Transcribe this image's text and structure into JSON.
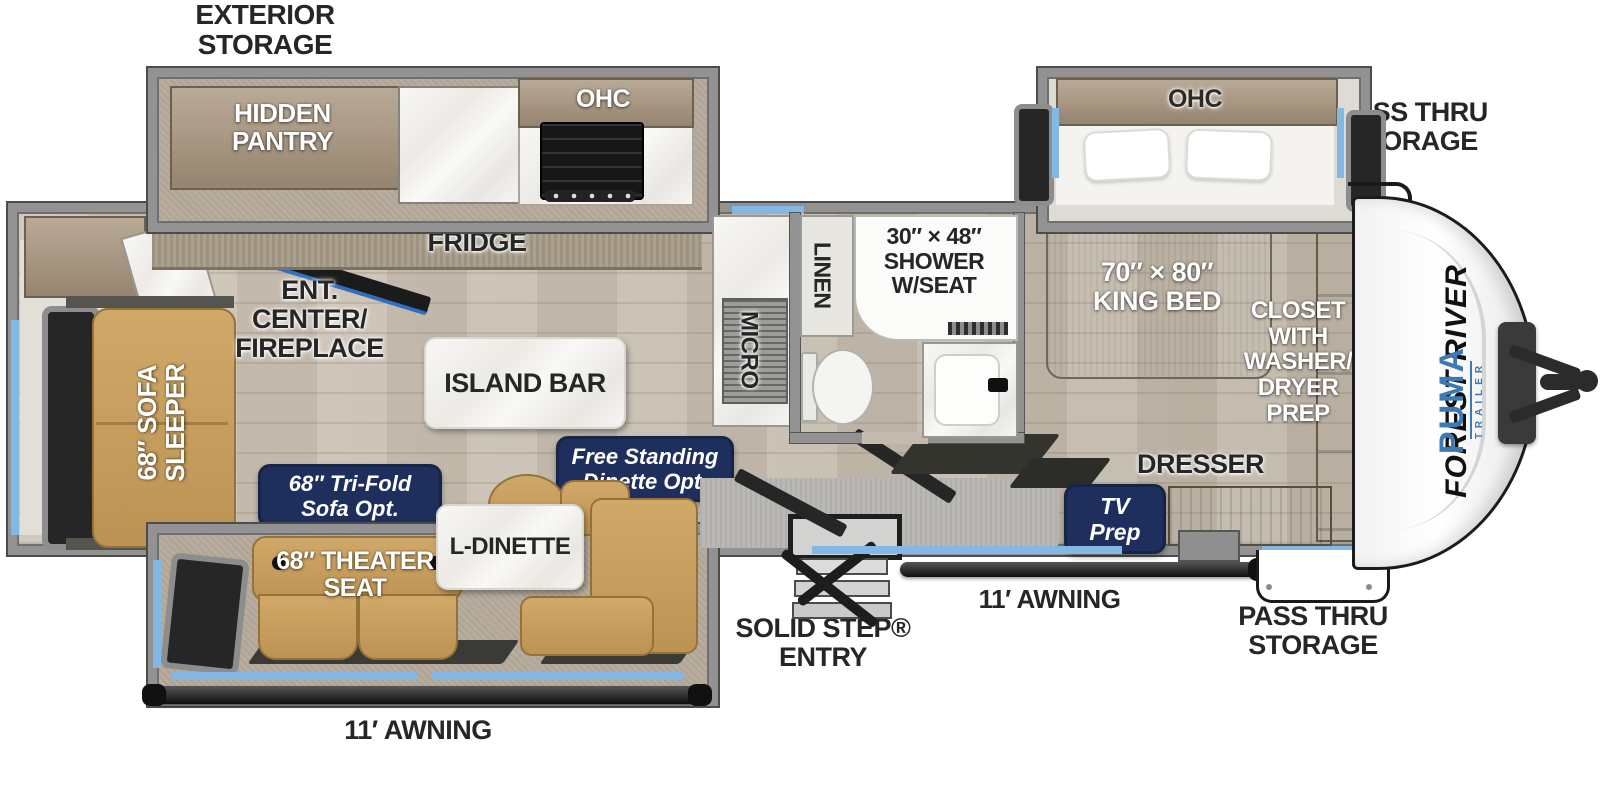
{
  "title": "Forest River Puma travel trailer floor plan",
  "labels": {
    "exterior_storage": "EXTERIOR\nSTORAGE",
    "pass_thru_top": "PASS THRU\nSTORAGE",
    "pass_thru_bottom": "PASS THRU\nSTORAGE",
    "awning_left": "11′ AWNING",
    "awning_right": "11′ AWNING",
    "solid_step": "SOLID STEP®\nENTRY",
    "hidden_pantry": "HIDDEN\nPANTRY",
    "ohc_kitchen": "OHC",
    "ohc_bedroom": "OHC",
    "fridge": "FRIDGE",
    "ent_center": "ENT.\nCENTER/\nFIREPLACE",
    "island_bar": "ISLAND BAR",
    "sofa_sleeper": "68″ SOFA\nSLEEPER",
    "tri_fold_opt": "68″ Tri-Fold\nSofa Opt.",
    "free_standing_opt": "Free Standing\nDinette Opt.",
    "l_dinette": "L-DINETTE",
    "theater_seat": "68″ THEATER\nSEAT",
    "micro": "MICRO",
    "linen": "LINEN",
    "shower": "30″ × 48″\nSHOWER\nW/SEAT",
    "king_bed": "70″ × 80″\nKING BED",
    "closet": "CLOSET\nWITH\nWASHER/\nDRYER\nPREP",
    "dresser": "DRESSER",
    "tv_prep": "TV\nPrep"
  },
  "brand": {
    "manufacturer": "FOREST RIVER",
    "model": "PUMA",
    "model_sub": "TRAILER"
  },
  "colors": {
    "accent_blue": "#84b8e4",
    "navy_chip": "#1e2f5d",
    "wall_gray": "#929292",
    "sofa_tan": "#c79f63",
    "wood_floor": "#c8bfb2",
    "brand_blue": "#3d7ab3"
  }
}
